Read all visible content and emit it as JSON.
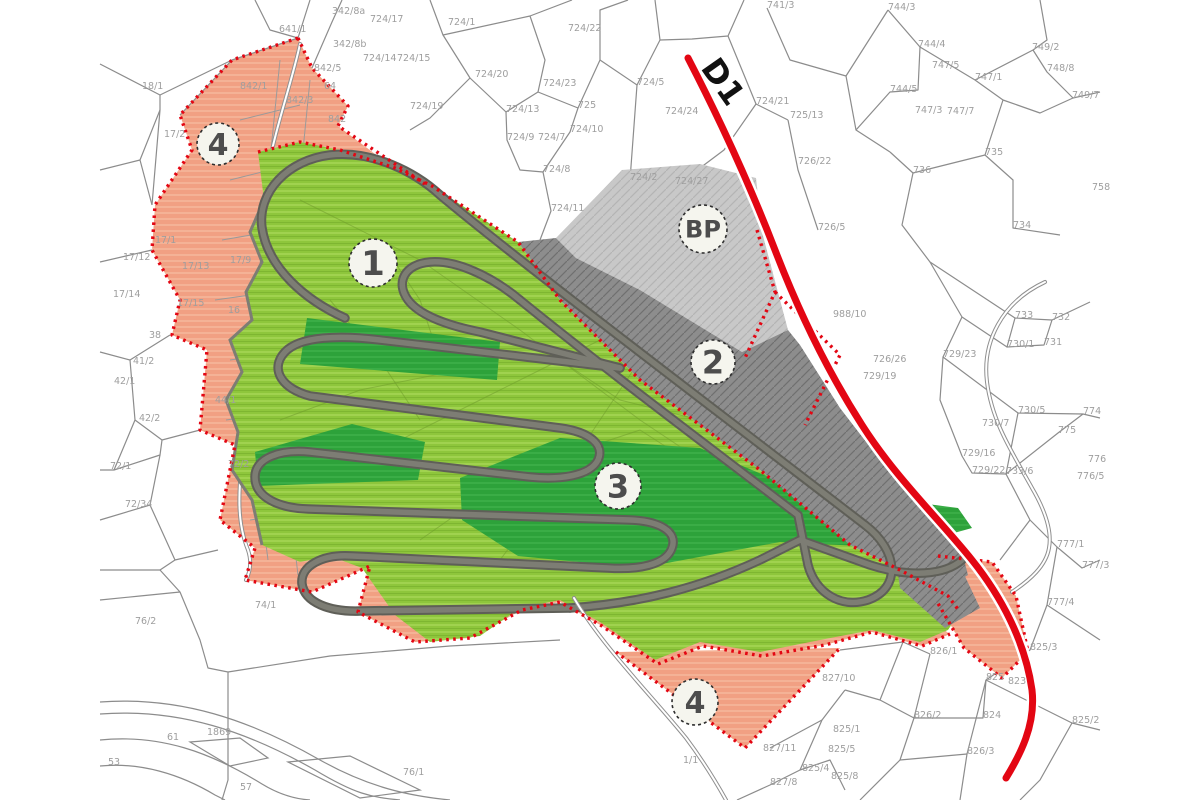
{
  "map": {
    "road_label": "D1",
    "colors": {
      "salmon": "#f1a083",
      "salmon_streak": "#f6ba9f",
      "green": "#8ec63c",
      "green_streak": "#a2d351",
      "dark_green": "#2da23a",
      "dark_green_streak": "#3fb24b",
      "dark_gray_zone": "#8d8d8d",
      "dark_gray_hatch": "#6f6f6f",
      "bp_gray": "#c8c8c8",
      "bp_hatch": "#b4b4b4",
      "track_gray": "#7d7d74",
      "red": "#e30613",
      "line": "#8c8c8c"
    },
    "zone_badges": [
      {
        "id": "zone-1",
        "label": "1",
        "x": 373,
        "y": 263,
        "r": 24,
        "font": 34
      },
      {
        "id": "zone-2",
        "label": "2",
        "x": 713,
        "y": 362,
        "r": 22,
        "font": 32
      },
      {
        "id": "zone-3",
        "label": "3",
        "x": 618,
        "y": 486,
        "r": 23,
        "font": 32
      },
      {
        "id": "zone-4-nw",
        "label": "4",
        "x": 218,
        "y": 144,
        "r": 21,
        "font": 30
      },
      {
        "id": "zone-4-s",
        "label": "4",
        "x": 695,
        "y": 702,
        "r": 23,
        "font": 30
      },
      {
        "id": "zone-bp",
        "label": "BP",
        "x": 703,
        "y": 229,
        "r": 24,
        "font": 24
      }
    ],
    "parcel_labels": [
      {
        "t": "342/8a",
        "x": 332,
        "y": 14
      },
      {
        "t": "724/17",
        "x": 370,
        "y": 22
      },
      {
        "t": "724/1",
        "x": 448,
        "y": 25
      },
      {
        "t": "741/3",
        "x": 767,
        "y": 8
      },
      {
        "t": "724/22",
        "x": 568,
        "y": 31
      },
      {
        "t": "641/1",
        "x": 279,
        "y": 32
      },
      {
        "t": "342/8b",
        "x": 333,
        "y": 47
      },
      {
        "t": "744/3",
        "x": 888,
        "y": 10
      },
      {
        "t": "744/4",
        "x": 918,
        "y": 47
      },
      {
        "t": "724/14",
        "x": 363,
        "y": 61
      },
      {
        "t": "724/15",
        "x": 397,
        "y": 61
      },
      {
        "t": "842/5",
        "x": 314,
        "y": 71
      },
      {
        "t": "724/20",
        "x": 475,
        "y": 77
      },
      {
        "t": "747/1",
        "x": 975,
        "y": 80
      },
      {
        "t": "749/2",
        "x": 1032,
        "y": 50
      },
      {
        "t": "748/8",
        "x": 1047,
        "y": 71
      },
      {
        "t": "724/23",
        "x": 543,
        "y": 86
      },
      {
        "t": "744/5",
        "x": 890,
        "y": 92
      },
      {
        "t": "64",
        "x": 324,
        "y": 89
      },
      {
        "t": "842/1",
        "x": 240,
        "y": 89
      },
      {
        "t": "18/1",
        "x": 142,
        "y": 89
      },
      {
        "t": "749/7",
        "x": 1072,
        "y": 98
      },
      {
        "t": "747/5",
        "x": 932,
        "y": 68
      },
      {
        "t": "724/19",
        "x": 410,
        "y": 109
      },
      {
        "t": "724/13",
        "x": 506,
        "y": 112
      },
      {
        "t": "725",
        "x": 578,
        "y": 108
      },
      {
        "t": "724/5",
        "x": 637,
        "y": 85
      },
      {
        "t": "842/3",
        "x": 286,
        "y": 103
      },
      {
        "t": "747/3",
        "x": 915,
        "y": 113
      },
      {
        "t": "747/7",
        "x": 947,
        "y": 114
      },
      {
        "t": "724/24",
        "x": 665,
        "y": 114
      },
      {
        "t": "842",
        "x": 328,
        "y": 122
      },
      {
        "t": "17/2",
        "x": 164,
        "y": 137
      },
      {
        "t": "724/10",
        "x": 570,
        "y": 132
      },
      {
        "t": "724/9",
        "x": 507,
        "y": 140
      },
      {
        "t": "724/7",
        "x": 538,
        "y": 140
      },
      {
        "t": "736",
        "x": 913,
        "y": 173
      },
      {
        "t": "735",
        "x": 985,
        "y": 155
      },
      {
        "t": "724/21",
        "x": 756,
        "y": 104
      },
      {
        "t": "724/8",
        "x": 543,
        "y": 172
      },
      {
        "t": "724/2",
        "x": 630,
        "y": 180
      },
      {
        "t": "724/27",
        "x": 675,
        "y": 184
      },
      {
        "t": "758",
        "x": 1092,
        "y": 190
      },
      {
        "t": "724/11",
        "x": 551,
        "y": 211
      },
      {
        "t": "725/13",
        "x": 790,
        "y": 118
      },
      {
        "t": "726/22",
        "x": 798,
        "y": 164
      },
      {
        "t": "726/5",
        "x": 818,
        "y": 230
      },
      {
        "t": "734",
        "x": 1013,
        "y": 228
      },
      {
        "t": "17/1",
        "x": 155,
        "y": 243
      },
      {
        "t": "17/12",
        "x": 123,
        "y": 260
      },
      {
        "t": "17/13",
        "x": 182,
        "y": 269
      },
      {
        "t": "17/9",
        "x": 230,
        "y": 263
      },
      {
        "t": "17/14",
        "x": 113,
        "y": 297
      },
      {
        "t": "17/15",
        "x": 177,
        "y": 306
      },
      {
        "t": "16",
        "x": 228,
        "y": 313
      },
      {
        "t": "733",
        "x": 1015,
        "y": 318
      },
      {
        "t": "732",
        "x": 1052,
        "y": 320
      },
      {
        "t": "988/10",
        "x": 833,
        "y": 317
      },
      {
        "t": "731",
        "x": 1044,
        "y": 345
      },
      {
        "t": "730/1",
        "x": 1007,
        "y": 347
      },
      {
        "t": "38",
        "x": 149,
        "y": 338
      },
      {
        "t": "726/26",
        "x": 873,
        "y": 362
      },
      {
        "t": "729/19",
        "x": 863,
        "y": 379
      },
      {
        "t": "729/23",
        "x": 943,
        "y": 357
      },
      {
        "t": "41/2",
        "x": 133,
        "y": 364
      },
      {
        "t": "42/1",
        "x": 114,
        "y": 384
      },
      {
        "t": "44/1",
        "x": 215,
        "y": 403
      },
      {
        "t": "730/5",
        "x": 1018,
        "y": 413
      },
      {
        "t": "774",
        "x": 1083,
        "y": 414
      },
      {
        "t": "42/2",
        "x": 139,
        "y": 421
      },
      {
        "t": "730/7",
        "x": 982,
        "y": 426
      },
      {
        "t": "775",
        "x": 1058,
        "y": 433
      },
      {
        "t": "729/16",
        "x": 962,
        "y": 456
      },
      {
        "t": "72/2",
        "x": 228,
        "y": 467
      },
      {
        "t": "776",
        "x": 1088,
        "y": 462
      },
      {
        "t": "729/22",
        "x": 972,
        "y": 473
      },
      {
        "t": "733/6",
        "x": 1006,
        "y": 474
      },
      {
        "t": "776/5",
        "x": 1077,
        "y": 479
      },
      {
        "t": "72/1",
        "x": 110,
        "y": 469
      },
      {
        "t": "72/34",
        "x": 125,
        "y": 507
      },
      {
        "t": "777/1",
        "x": 1057,
        "y": 547
      },
      {
        "t": "777/3",
        "x": 1082,
        "y": 568
      },
      {
        "t": "74/1",
        "x": 255,
        "y": 608
      },
      {
        "t": "76/2",
        "x": 135,
        "y": 624
      },
      {
        "t": "777/4",
        "x": 1047,
        "y": 605
      },
      {
        "t": "826/1",
        "x": 930,
        "y": 654
      },
      {
        "t": "825/3",
        "x": 1030,
        "y": 650
      },
      {
        "t": "823",
        "x": 1008,
        "y": 684
      },
      {
        "t": "825",
        "x": 986,
        "y": 680
      },
      {
        "t": "827/10",
        "x": 822,
        "y": 681
      },
      {
        "t": "826/2",
        "x": 914,
        "y": 718
      },
      {
        "t": "824",
        "x": 983,
        "y": 718
      },
      {
        "t": "825/2",
        "x": 1072,
        "y": 723
      },
      {
        "t": "61",
        "x": 167,
        "y": 740
      },
      {
        "t": "1869",
        "x": 207,
        "y": 735
      },
      {
        "t": "826/3",
        "x": 967,
        "y": 754
      },
      {
        "t": "827/11",
        "x": 763,
        "y": 751
      },
      {
        "t": "1/1",
        "x": 683,
        "y": 763
      },
      {
        "t": "76/1",
        "x": 403,
        "y": 775
      },
      {
        "t": "825/1",
        "x": 833,
        "y": 732
      },
      {
        "t": "825/5",
        "x": 828,
        "y": 752
      },
      {
        "t": "53",
        "x": 108,
        "y": 765
      },
      {
        "t": "825/4",
        "x": 802,
        "y": 771
      },
      {
        "t": "825/8",
        "x": 831,
        "y": 779
      },
      {
        "t": "57",
        "x": 240,
        "y": 790
      },
      {
        "t": "827/8",
        "x": 770,
        "y": 785
      }
    ]
  }
}
